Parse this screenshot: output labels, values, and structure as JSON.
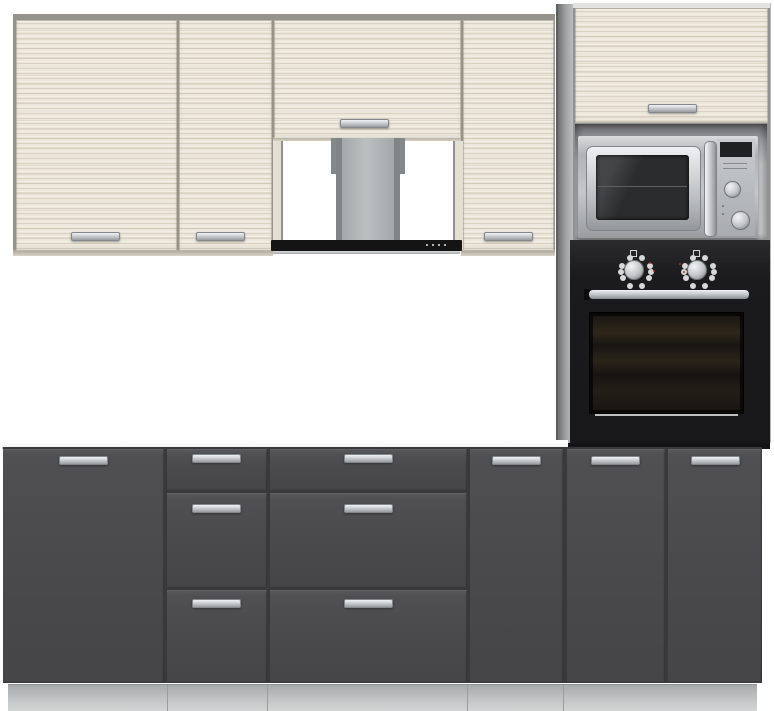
{
  "scene": {
    "type": "product-photo",
    "subject": "Modular kitchen furniture set with built-in appliances",
    "background": "#ffffff"
  },
  "palette": {
    "background": "#ffffff",
    "wood_light": "#ece7da",
    "wood_streak": "#d8d0bc",
    "carcass_grey": "#96938c",
    "side_panel_grey": "#a0a2a4",
    "base_door_grey": "#4b4b4d",
    "door_gap_dark": "#39393b",
    "plinth_grey": "#c2c4c5",
    "steel_light": "#eef0f1",
    "steel_mid": "#b9bcbe",
    "steel_dark": "#8e9193",
    "appliance_black": "#1b1b1d",
    "oven_glass_dark": "#171411",
    "indicator_red": "#a83229",
    "niche_white": "#ffffff",
    "hood_bar_black": "#141415"
  },
  "wall_section": {
    "cabinets": [
      {
        "name": "wall-door-left",
        "finish": "light-wood",
        "handle": "horizontal-bottom-center"
      },
      {
        "name": "wall-door-mid",
        "finish": "light-wood",
        "handle": "horizontal-bottom-center"
      },
      {
        "name": "hood-top-door",
        "finish": "light-wood",
        "handle": "horizontal-bottom-center"
      },
      {
        "name": "wall-door-right",
        "finish": "light-wood",
        "handle": "horizontal-bottom-center"
      }
    ],
    "hood": {
      "name": "chimney-hood",
      "chimney_finish": "grey-telescopic",
      "bar_finish": "black-with-steel-base",
      "control_buttons": 4
    }
  },
  "tall_unit": {
    "top_door": {
      "name": "tall-top-door",
      "finish": "light-wood",
      "handle": "horizontal-bottom-center"
    },
    "microwave": {
      "finish": "stainless-steel",
      "parts": [
        "glass-door",
        "vertical-bar-handle",
        "display",
        "upper-knob",
        "lower-knob"
      ]
    },
    "oven": {
      "finish": "black-glass",
      "knobs": 2,
      "red_indicator_lights": 4,
      "handle": "horizontal-steel-bar"
    }
  },
  "base_section": {
    "worktop": "white",
    "units": [
      {
        "name": "base-door-wide",
        "handle": "horizontal-top-center"
      },
      {
        "name": "drawer-stack-narrow",
        "drawers": 3
      },
      {
        "name": "drawer-stack-wide",
        "drawers": 3
      },
      {
        "name": "base-door-mid",
        "handle": "horizontal-top-center"
      },
      {
        "name": "base-door-under-oven-left",
        "handle": "horizontal-top-center"
      },
      {
        "name": "base-door-under-oven-right",
        "handle": "horizontal-top-center"
      }
    ],
    "plinth": {
      "finish": "light-grey",
      "seams": 4
    }
  }
}
